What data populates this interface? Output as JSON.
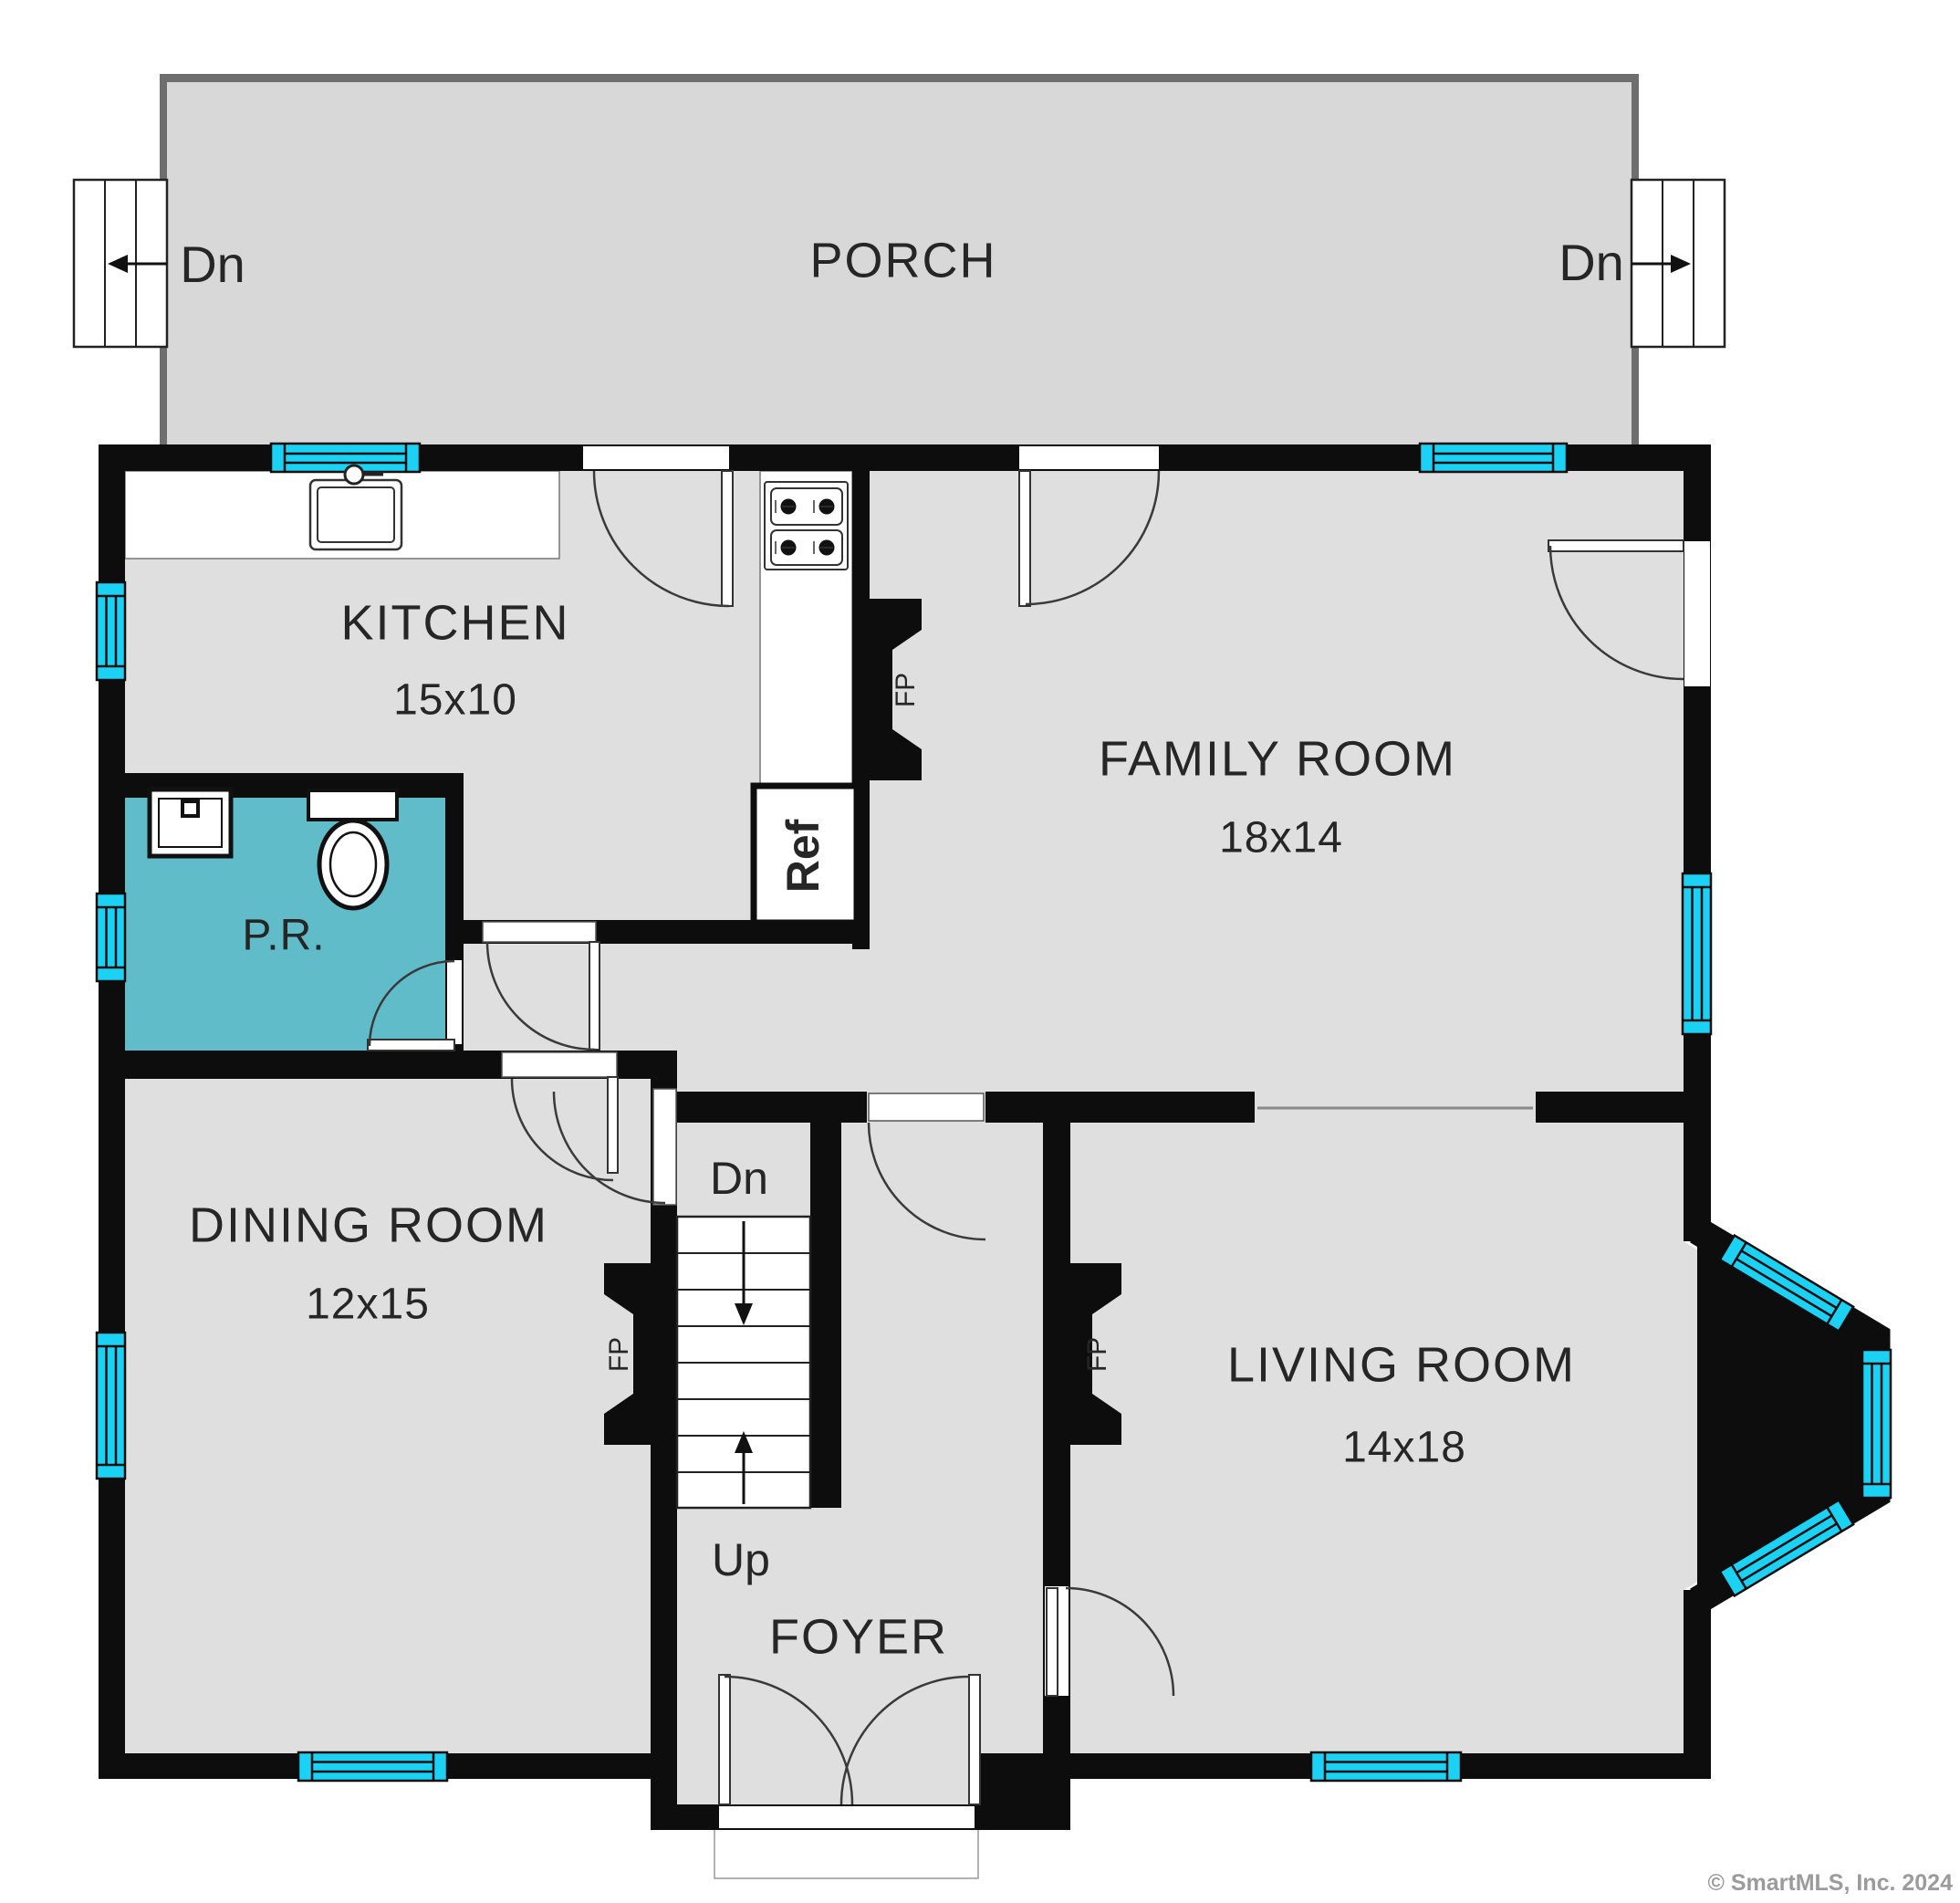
{
  "plan": {
    "porch": {
      "label": "PORCH",
      "left_stairs_label": "Dn",
      "right_stairs_label": "Dn"
    },
    "rooms": {
      "kitchen": {
        "name": "KITCHEN",
        "dimensions": "15x10"
      },
      "family_room": {
        "name": "FAMILY ROOM",
        "dimensions": "18x14"
      },
      "dining_room": {
        "name": "DINING ROOM",
        "dimensions": "12x15"
      },
      "living_room": {
        "name": "LIVING ROOM",
        "dimensions": "14x18"
      },
      "powder_room": {
        "name": "P.R."
      },
      "foyer": {
        "name": "FOYER"
      }
    },
    "stairs": {
      "down_label": "Dn",
      "up_label": "Up"
    },
    "fixtures": {
      "refrigerator_label": "Ref",
      "fireplace_label": "FP"
    },
    "watermark": "© SmartMLS, Inc. 2024",
    "colors": {
      "wall": "#0d0d0d",
      "floor": "#dfdfdf",
      "porch_floor": "#d8d8d8",
      "porch_edge": "#6e6e6e",
      "window": "#1bd2f4",
      "powder_room": "#61bcca"
    }
  }
}
